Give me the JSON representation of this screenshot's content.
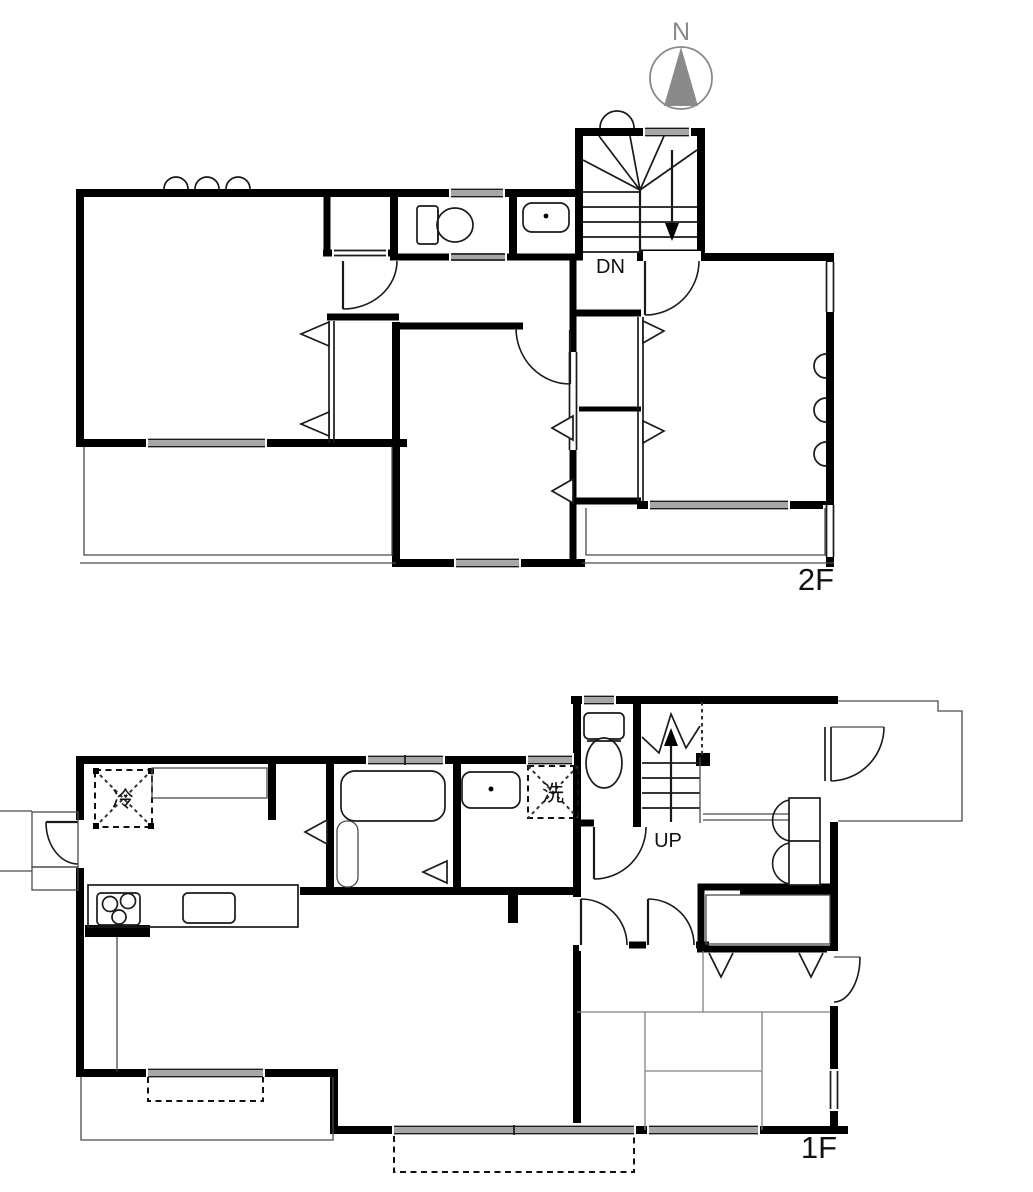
{
  "page": {
    "type": "two-story house floor plan"
  },
  "compass": {
    "label": "N"
  },
  "floor_2f": {
    "label": "2F",
    "stair_label": "DN"
  },
  "floor_1f": {
    "label": "1F",
    "stair_label": "UP",
    "refrigerator_label": "冷",
    "washer_label": "洗"
  },
  "colors": {
    "wall": "#000000",
    "window": "#a6a6a6",
    "compass": "#8a8a8a",
    "text": "#111111",
    "background": "#ffffff"
  }
}
